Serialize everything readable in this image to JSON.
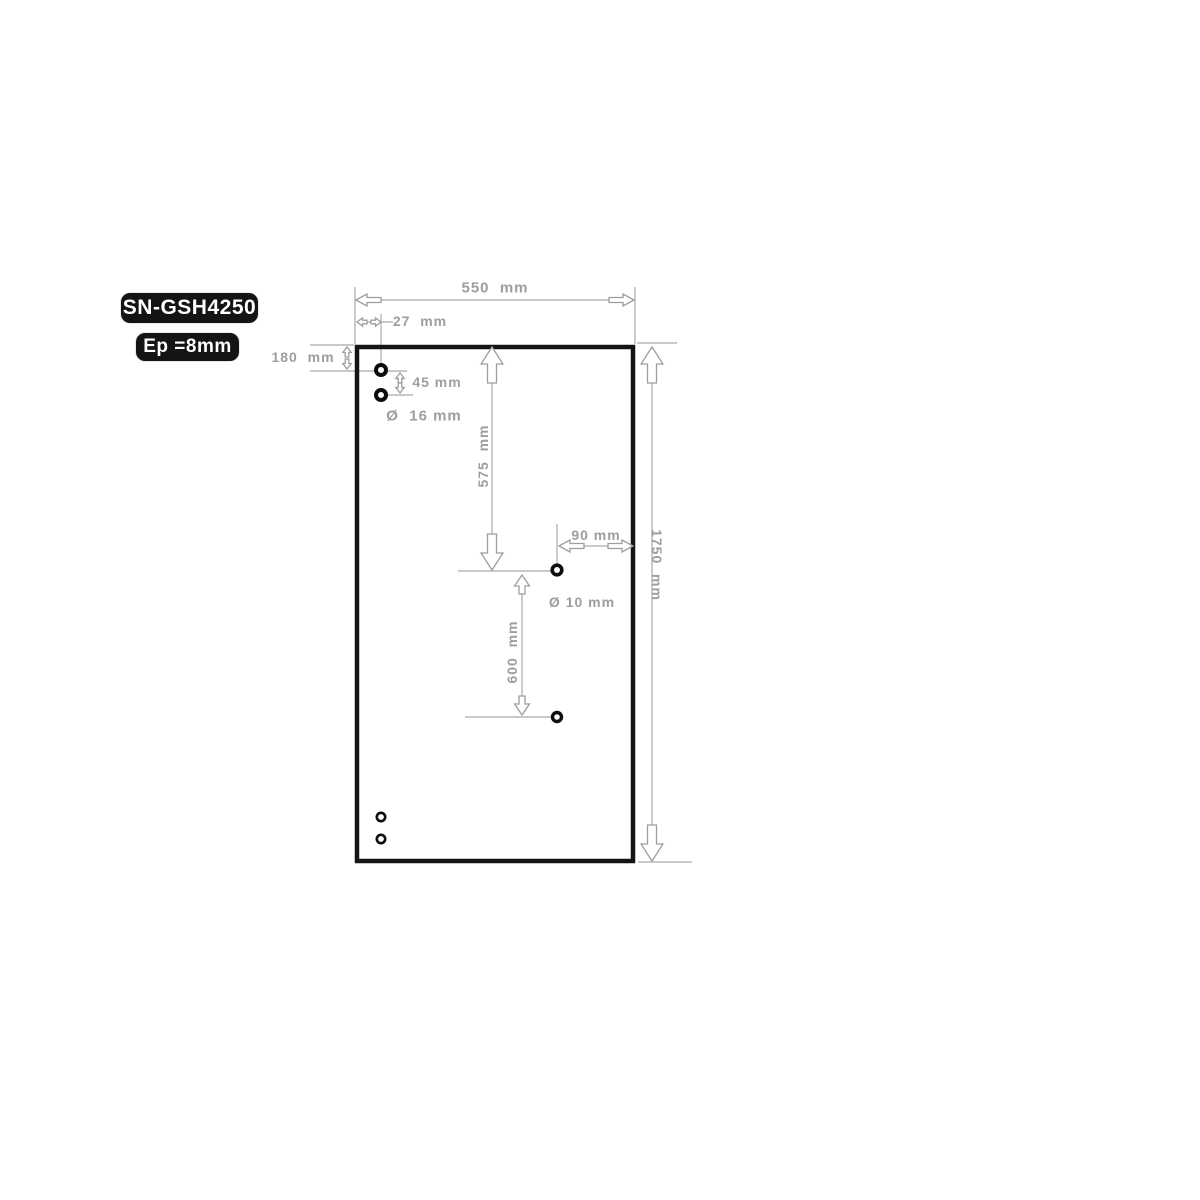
{
  "title_badges": {
    "model": "SN-GSH4250",
    "thickness": "Ep =8mm"
  },
  "dimensions": {
    "panel_width": "550  mm",
    "hole_offset_from_edge": "27  mm",
    "top_offset": "180  mm",
    "top_hole_spacing": "45 mm",
    "large_hole_diameter": "Ø  16 mm",
    "upper_span": "575  mm",
    "side_hole_offset": "90 mm",
    "panel_height": "1750  mm",
    "small_hole_diameter": "Ø 10 mm",
    "lower_span": "600  mm"
  },
  "colors": {
    "dimension_text": "#9e9e9e",
    "dimension_line": "#a9a9a9",
    "arrow_stroke": "#9e9e9e",
    "arrow_fill": "#ffffff",
    "panel_border": "#151515",
    "hole_ring": "#0d0d0d",
    "badge_bg": "#141414",
    "badge_text": "#ffffff"
  }
}
